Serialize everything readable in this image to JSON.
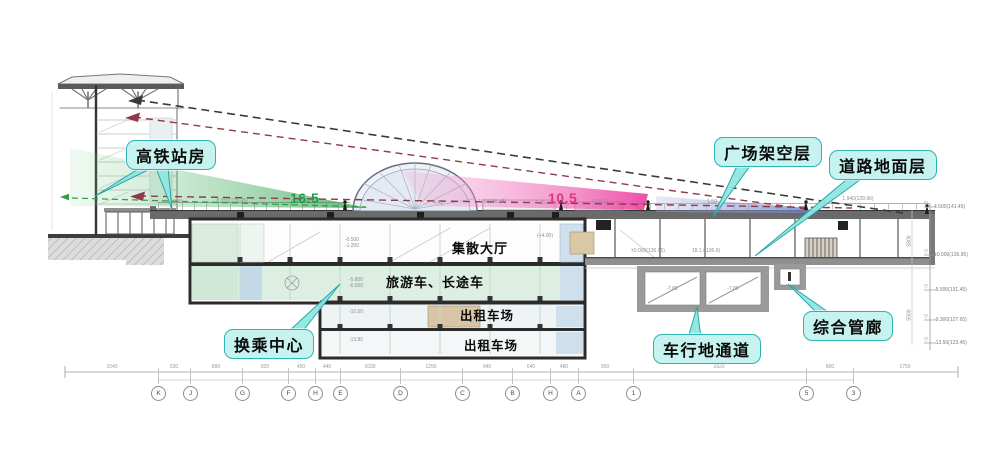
{
  "callouts": {
    "station_building": "高铁站房",
    "plaza_elevated_level": "广场架空层",
    "road_ground_level": "道路地面层",
    "utility_corridor": "综合管廊",
    "vehicle_underpass": "车行地通道",
    "transfer_center": "换乘中心"
  },
  "room_labels": {
    "concourse_hall": "集散大厅",
    "tour_coach_level": "旅游车、长途车",
    "taxi_level_1": "出租车场",
    "taxi_level_2": "出租车场"
  },
  "sightline_values": {
    "green_height": "16.5",
    "pink_height": "10.5"
  },
  "grid": {
    "bubbles": [
      {
        "label": "K",
        "x": 158
      },
      {
        "label": "J",
        "x": 190
      },
      {
        "label": "G",
        "x": 242
      },
      {
        "label": "F",
        "x": 288
      },
      {
        "label": "H",
        "x": 315
      },
      {
        "label": "E",
        "x": 340
      },
      {
        "label": "D",
        "x": 400
      },
      {
        "label": "C",
        "x": 462
      },
      {
        "label": "B",
        "x": 512
      },
      {
        "label": "H",
        "x": 550
      },
      {
        "label": "A",
        "x": 578
      },
      {
        "label": "1",
        "x": 633
      },
      {
        "label": "5",
        "x": 806
      },
      {
        "label": "3",
        "x": 853
      }
    ],
    "dims": [
      {
        "label": "1540",
        "x": 112
      },
      {
        "label": "530",
        "x": 174
      },
      {
        "label": "890",
        "x": 216
      },
      {
        "label": "820",
        "x": 265
      },
      {
        "label": "450",
        "x": 301
      },
      {
        "label": "440",
        "x": 327
      },
      {
        "label": "1030",
        "x": 370
      },
      {
        "label": "1250",
        "x": 431
      },
      {
        "label": "940",
        "x": 487
      },
      {
        "label": "640",
        "x": 531
      },
      {
        "label": "480",
        "x": 564
      },
      {
        "label": "900",
        "x": 605
      },
      {
        "label": "2920",
        "x": 719
      },
      {
        "label": "800",
        "x": 830
      },
      {
        "label": "1750",
        "x": 905
      }
    ]
  },
  "elevations": {
    "marks": [
      {
        "label": "4.500(141.45)",
        "y": 207
      },
      {
        "label": "±0.000(136.95)",
        "y": 255
      },
      {
        "label": "-5.500(131.45)",
        "y": 290
      },
      {
        "label": "-9.300(127.65)",
        "y": 320
      },
      {
        "label": "-13.50(123.45)",
        "y": 343
      }
    ],
    "vertical_dims": [
      {
        "label": "5800",
        "y": 238
      },
      {
        "label": "5500",
        "y": 312
      }
    ]
  },
  "tiny_notes": [
    {
      "t": "0.45",
      "x": 178,
      "y": 202
    },
    {
      "t": "8.950(138.45)",
      "x": 232,
      "y": 201
    },
    {
      "t": "(136.95)",
      "x": 300,
      "y": 202
    },
    {
      "t": "4.45",
      "x": 438,
      "y": 203
    },
    {
      "t": "7.92(136.45)",
      "x": 492,
      "y": 202
    },
    {
      "t": "4.45",
      "x": 540,
      "y": 203
    },
    {
      "t": "(138.2)",
      "x": 600,
      "y": 202
    },
    {
      "t": "1.50",
      "x": 712,
      "y": 202
    },
    {
      "t": "1.940(139.96)",
      "x": 858,
      "y": 199
    },
    {
      "t": "(+4.00)",
      "x": 545,
      "y": 236
    },
    {
      "t": "-0.500",
      "x": 352,
      "y": 240
    },
    {
      "t": "-1.200",
      "x": 352,
      "y": 246
    },
    {
      "t": "-5.800",
      "x": 356,
      "y": 280
    },
    {
      "t": "-6.500",
      "x": 356,
      "y": 286
    },
    {
      "t": "-10.50",
      "x": 356,
      "y": 312
    },
    {
      "t": "-13.80",
      "x": 356,
      "y": 340
    },
    {
      "t": "±0.000(136.95)",
      "x": 648,
      "y": 251
    },
    {
      "t": "18.1 /(136.9)",
      "x": 706,
      "y": 251
    },
    {
      "t": "-7.80",
      "x": 672,
      "y": 289
    },
    {
      "t": "-7.80",
      "x": 733,
      "y": 289
    }
  ],
  "colors": {
    "callout_fill": "#c6f3ef",
    "callout_border": "#2fb3b0",
    "green_cone": "#3aa55a",
    "pink_cone": "#ea3f9a",
    "purple_cone": "#7b8cc8",
    "sightline_dark": "#3a3a3a",
    "sightline_red": "#8f3a4a",
    "green_value_color": "#1f9e4a",
    "pink_value_color": "#e0367e"
  }
}
